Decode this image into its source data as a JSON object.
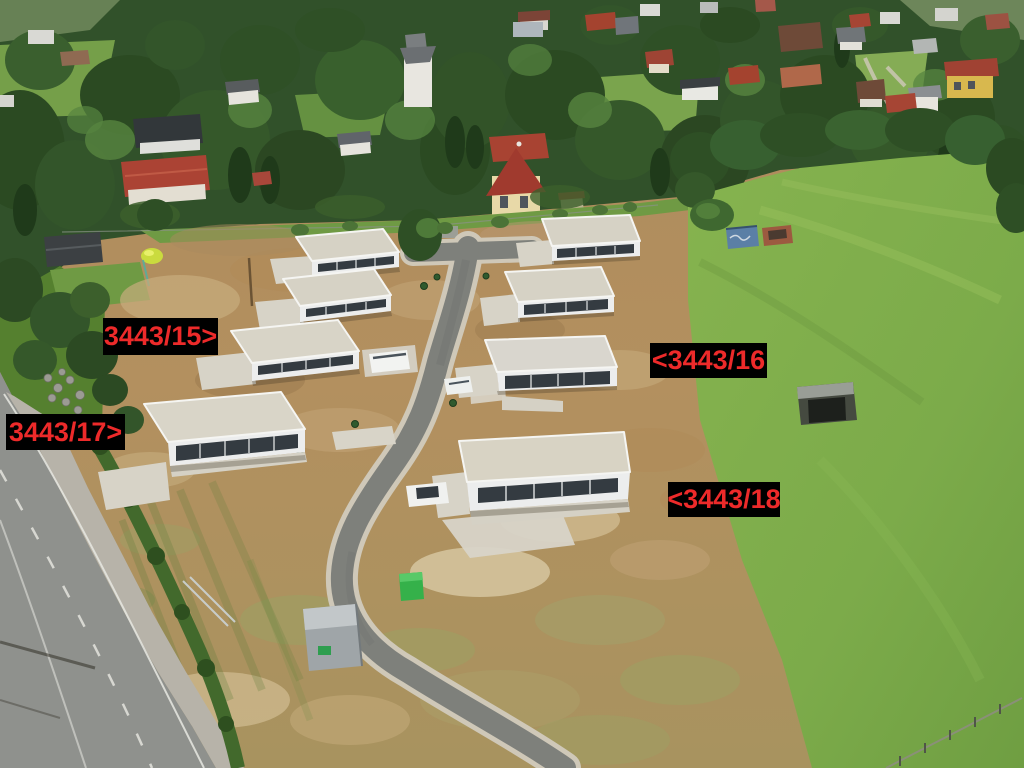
{
  "annotations": {
    "style": {
      "text_color": "#ed2a2a",
      "background_color": "#000000"
    },
    "parcels": [
      {
        "id": "parcel-3443-15",
        "text": "3443/15>"
      },
      {
        "id": "parcel-3443-16",
        "text": "<3443/16"
      },
      {
        "id": "parcel-3443-17",
        "text": "3443/17>"
      },
      {
        "id": "parcel-3443-18",
        "text": "<3443/18"
      }
    ]
  },
  "scene": {
    "kind": "aerial-drone-photo-of-new-housing-development",
    "objects": [
      "eight-new-flat-roof-houses-under-construction",
      "new-s-curve-access-road",
      "old-road-with-sidewalk-and-hedge",
      "green-meadow-parcel-right",
      "village-with-trees-top",
      "white-van",
      "white-car-on-road",
      "white-car-at-house",
      "portable-toilet",
      "site-container",
      "blue-container",
      "field-shed",
      "fence-bottom-right"
    ],
    "palette": {
      "dirt": "#b3905f",
      "dirt_pale": "#d5c29a",
      "dirt_dark": "#8f7148",
      "field_green": "#7cab4a",
      "tree_dark": "#2b4a22",
      "house_wall": "#eceded",
      "house_roof": "#d6d2c5",
      "window_band": "#343b41",
      "new_asphalt": "#7e807b",
      "old_asphalt": "#8f918d",
      "sidewalk": "#b7b3a9",
      "hedge": "#42692c",
      "label_red": "#ed2a2a",
      "label_bg": "#000000"
    }
  }
}
